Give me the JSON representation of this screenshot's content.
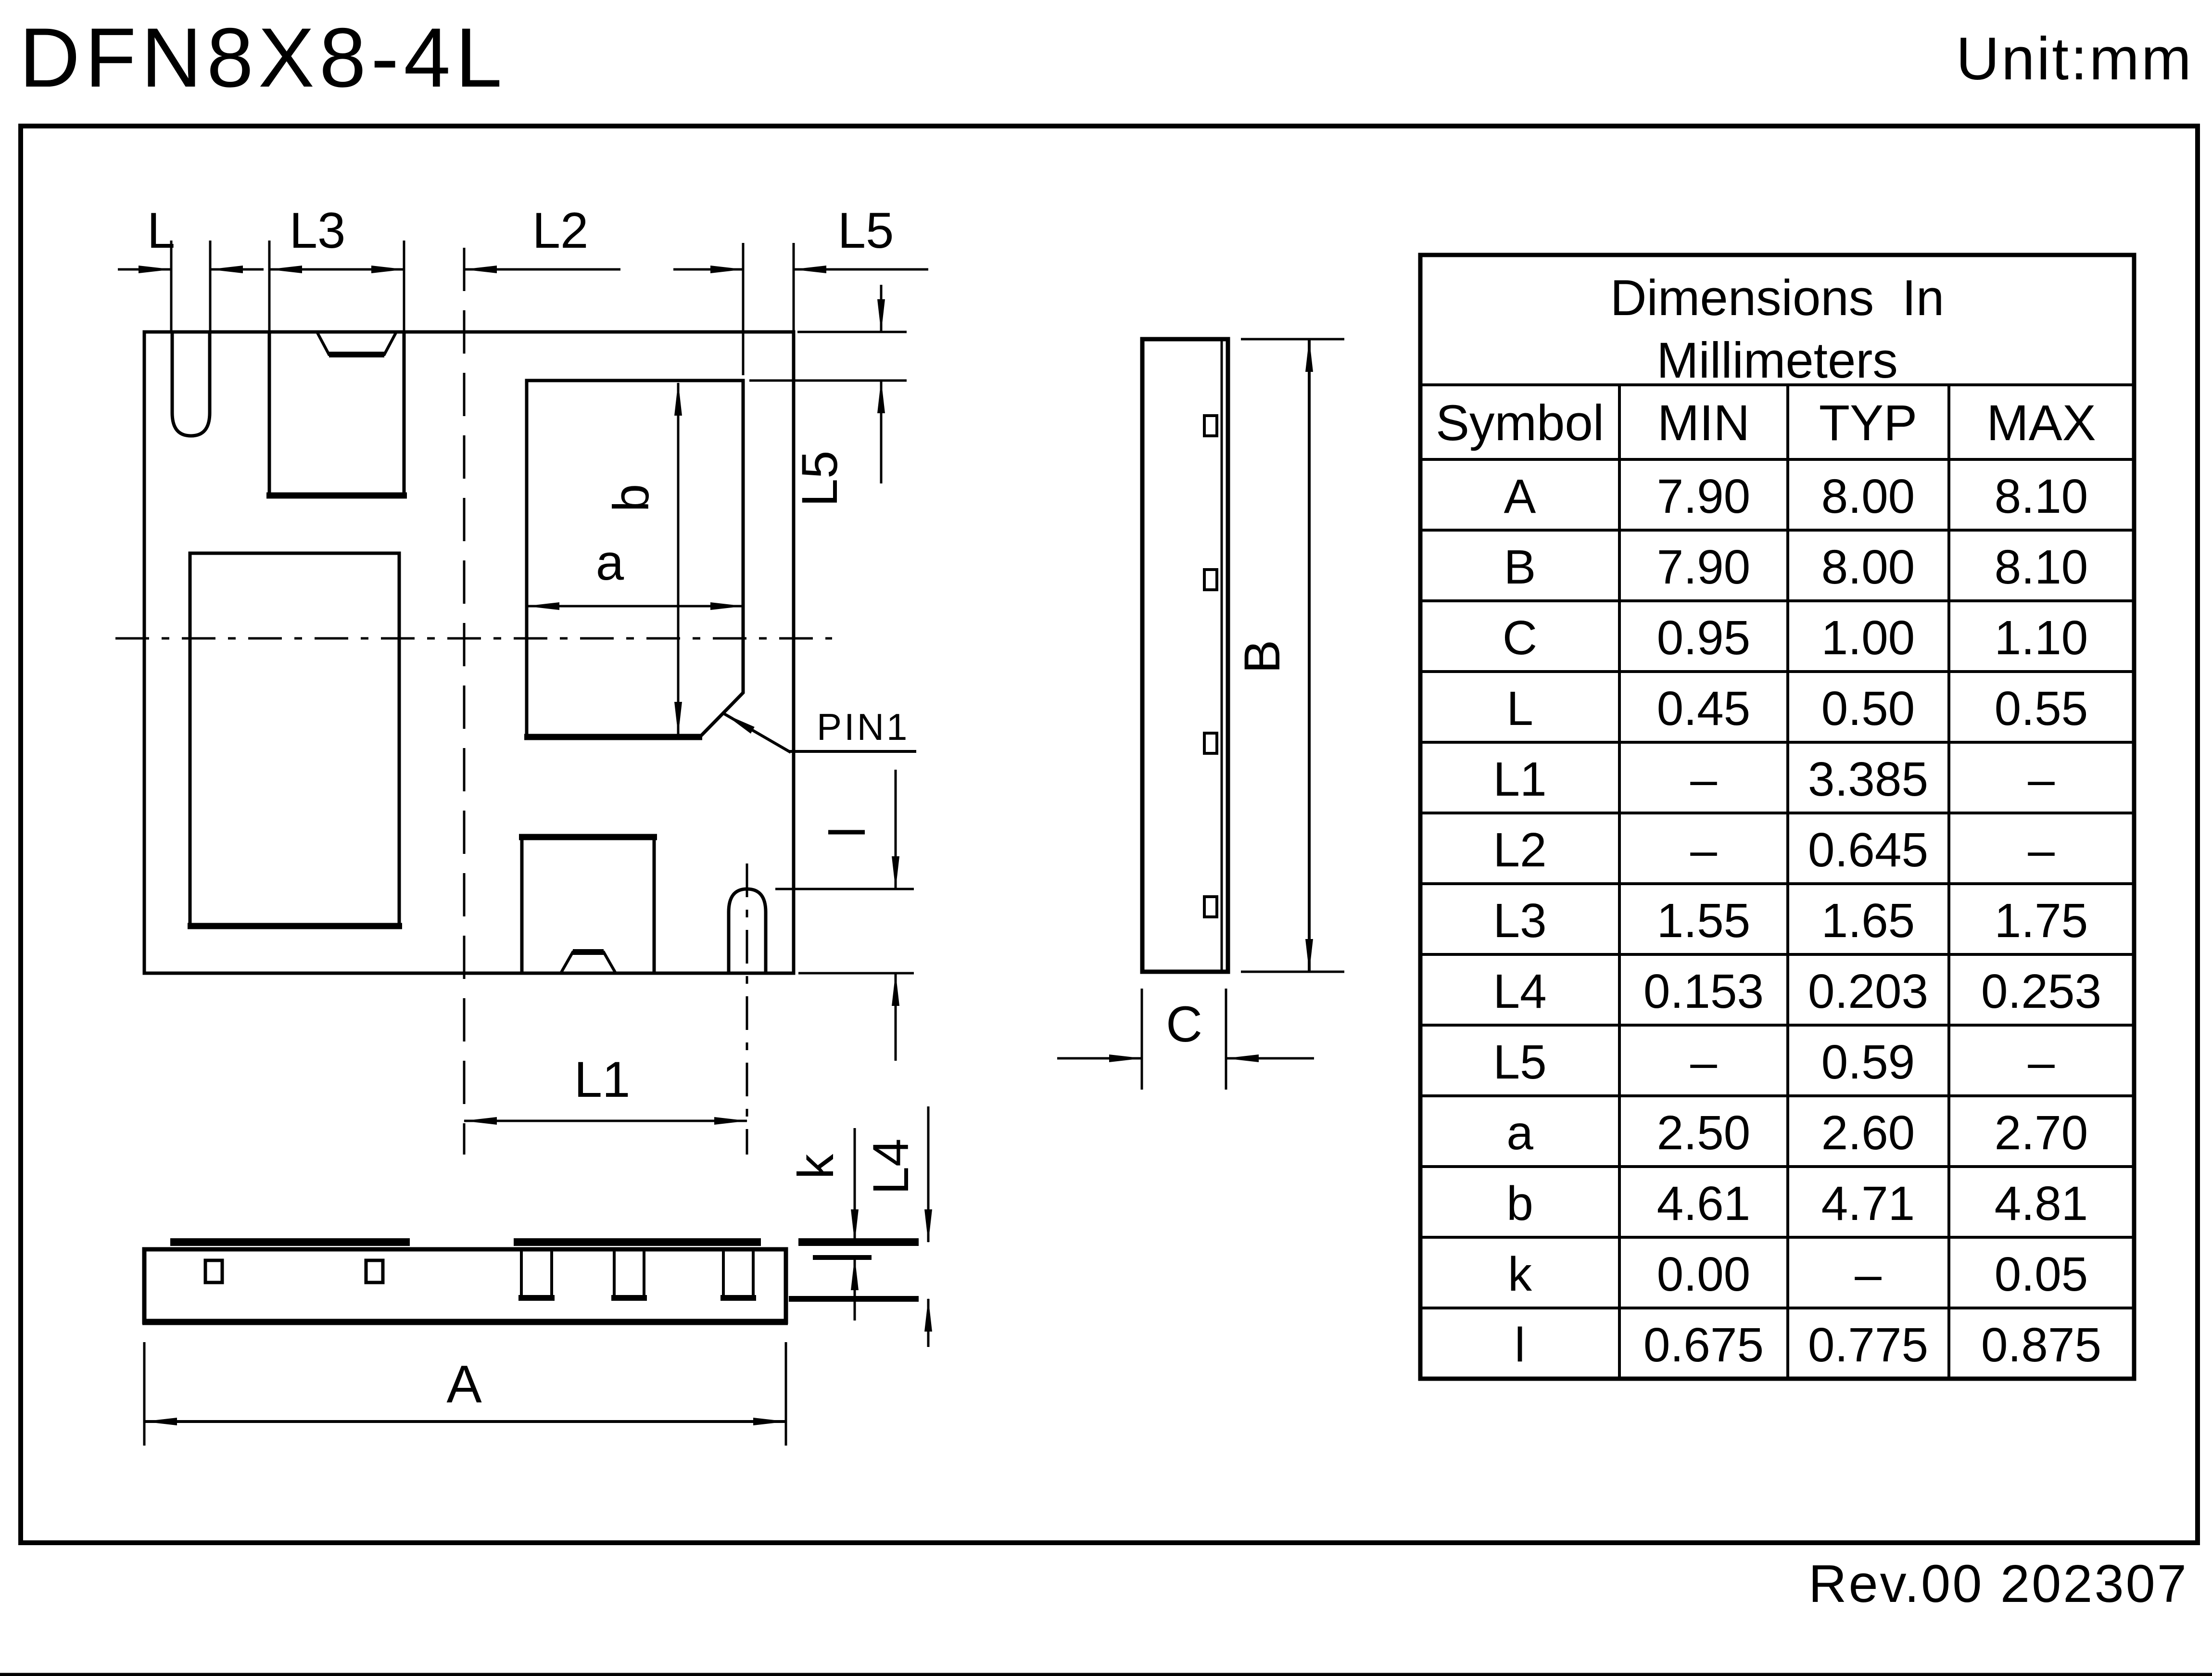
{
  "page": {
    "title": "DFN8X8-4L",
    "unit": "Unit:mm",
    "revision": "Rev.00 202307"
  },
  "labels": {
    "L": "L",
    "L3": "L3",
    "L2": "L2",
    "L5_top": "L5",
    "L5_right": "L5",
    "l_right": "l",
    "L1": "L1",
    "a": "a",
    "b": "b",
    "pin1": "PIN1",
    "B": "B",
    "C": "C",
    "A": "A",
    "k": "k",
    "L4": "L4"
  },
  "table": {
    "title_line1": "Dimensions  In",
    "title_line2": "Millimeters",
    "columns": [
      "Symbol",
      "MIN",
      "TYP",
      "MAX"
    ],
    "rows": [
      {
        "symbol": "A",
        "min": "7.90",
        "typ": "8.00",
        "max": "8.10"
      },
      {
        "symbol": "B",
        "min": "7.90",
        "typ": "8.00",
        "max": "8.10"
      },
      {
        "symbol": "C",
        "min": "0.95",
        "typ": "1.00",
        "max": "1.10"
      },
      {
        "symbol": "L",
        "min": "0.45",
        "typ": "0.50",
        "max": "0.55"
      },
      {
        "symbol": "L1",
        "min": "–",
        "typ": "3.385",
        "max": "–"
      },
      {
        "symbol": "L2",
        "min": "–",
        "typ": "0.645",
        "max": "–"
      },
      {
        "symbol": "L3",
        "min": "1.55",
        "typ": "1.65",
        "max": "1.75"
      },
      {
        "symbol": "L4",
        "min": "0.153",
        "typ": "0.203",
        "max": "0.253"
      },
      {
        "symbol": "L5",
        "min": "–",
        "typ": "0.59",
        "max": "–"
      },
      {
        "symbol": "a",
        "min": "2.50",
        "typ": "2.60",
        "max": "2.70"
      },
      {
        "symbol": "b",
        "min": "4.61",
        "typ": "4.71",
        "max": "4.81"
      },
      {
        "symbol": "k",
        "min": "0.00",
        "typ": "–",
        "max": "0.05"
      },
      {
        "symbol": "l",
        "min": "0.675",
        "typ": "0.775",
        "max": "0.875"
      }
    ]
  }
}
